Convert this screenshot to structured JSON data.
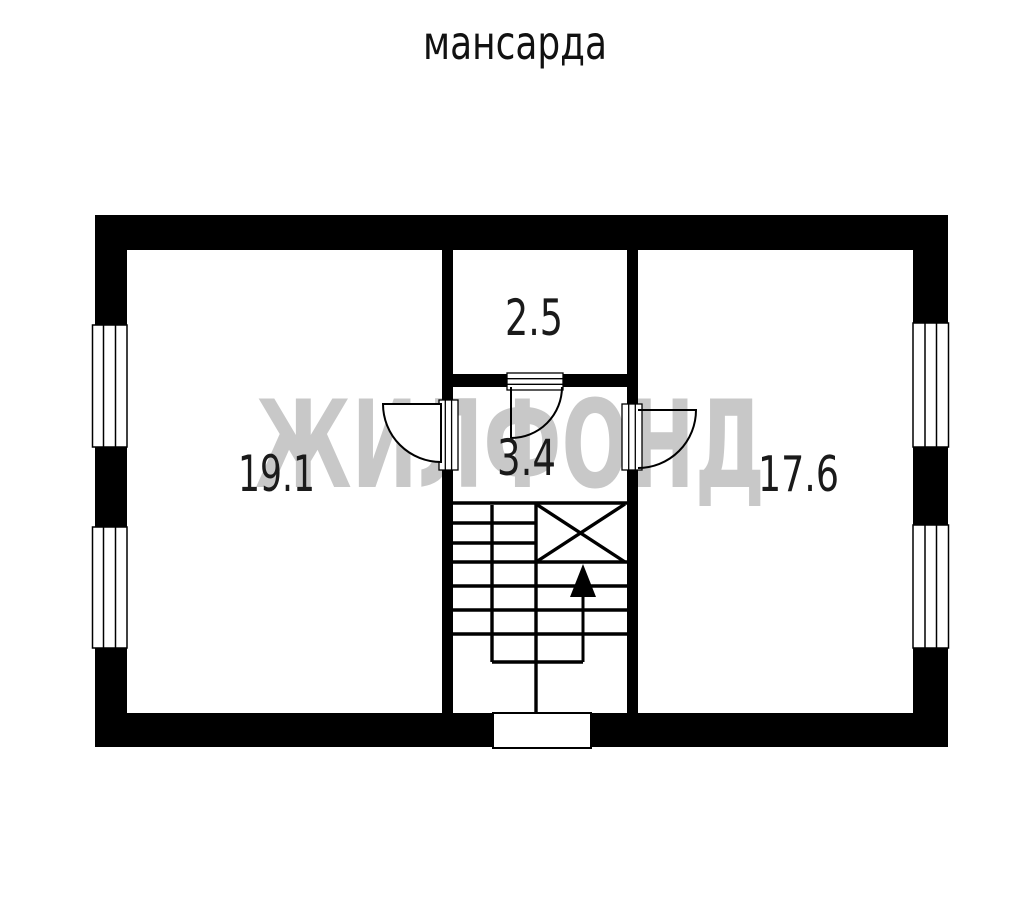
{
  "title": "мансарда",
  "watermark": {
    "text": "ЖИЛФОНД",
    "color": "#c8c8c8"
  },
  "plan": {
    "rooms": [
      {
        "id": "room-19-1",
        "area_label": "19.1"
      },
      {
        "id": "room-2-5",
        "area_label": "2.5"
      },
      {
        "id": "room-3-4",
        "area_label": "3.4"
      },
      {
        "id": "room-17-6",
        "area_label": "17.6"
      }
    ]
  },
  "colors": {
    "background": "#ffffff",
    "walls": "#000000",
    "labels": "#1a1a1a",
    "watermark": "#c8c8c8"
  }
}
